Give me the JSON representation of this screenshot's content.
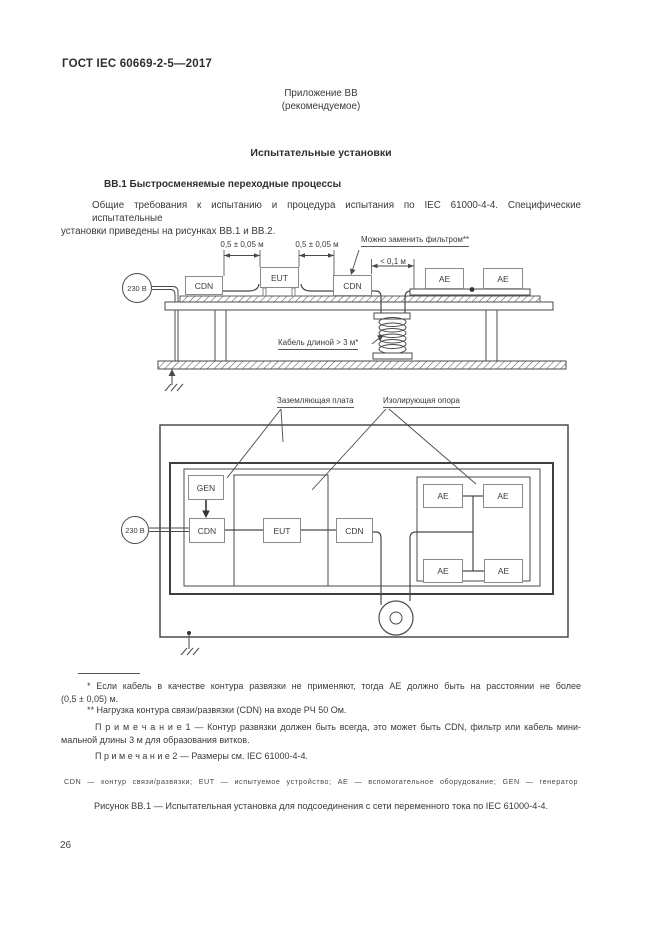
{
  "page": {
    "standard_ref": "ГОСТ IEC 60669-2-5—2017",
    "annex_label": "Приложение ВВ",
    "annex_type": "(рекомендуемое)",
    "doc_title": "Испытательные установки",
    "section_heading": "ВВ.1  Быстросменяемые переходные процессы",
    "page_number": "26"
  },
  "para": {
    "lines": [
      "Общие требования к испытанию и процедура испытания по IEC 61000-4-4. Специфические испытательные",
      "установки приведены на рисунках ВВ.1 и ВВ.2."
    ]
  },
  "figure1": {
    "source_label": "230 В",
    "cdn_label": "CDN",
    "eut_label": "EUT",
    "ae_label": "AE",
    "dim_left": "0,5 ± 0,05 м",
    "dim_right": "0,5 ± 0,05 м",
    "dim_gap": "< 0,1 м",
    "filter_note": "Можно заменить фильтром**",
    "cable_note": "Кабель длиной > 3 м*"
  },
  "figure2": {
    "source_label": "230 В",
    "gen_label": "GEN",
    "cdn_label": "CDN",
    "eut_label": "EUT",
    "ae_label": "AE",
    "ground_plate_label": "Заземляющая плата",
    "insulating_support_label": "Изолирующая опора"
  },
  "footnotes": {
    "fn1_lines": [
      "* Если кабель в качестве контура развязки не применяют, тогда АЕ должно быть на расстоянии не более",
      "(0,5 ± 0,05) м."
    ],
    "fn2": "** Нагрузка контура связи/развязки (CDN) на входе РЧ 50 Ом.",
    "note1_lines": [
      "П р и м е ч а н и е   1 — Контур развязки должен быть всегда, это может быть CDN, фильтр или кабель мини-",
      "мальной длины 3 м для образования витков."
    ],
    "note2": "П р и м е ч а н и е   2 — Размеры см. IEC 61000-4-4.",
    "abbreviations": "CDN — контур связи/развязки; EUT — испытуемое устройство; АЕ — вспомогательное оборудование; GEN — генератор",
    "figure_caption": "Рисунок ВВ.1 — Испытательная установка для подсоединения с сети переменного тока по IEC 61000-4-4."
  },
  "colors": {
    "ink": "#3a3a3a",
    "diagram_line": "#4a4a4a",
    "box_border": "#8a8a8a"
  }
}
